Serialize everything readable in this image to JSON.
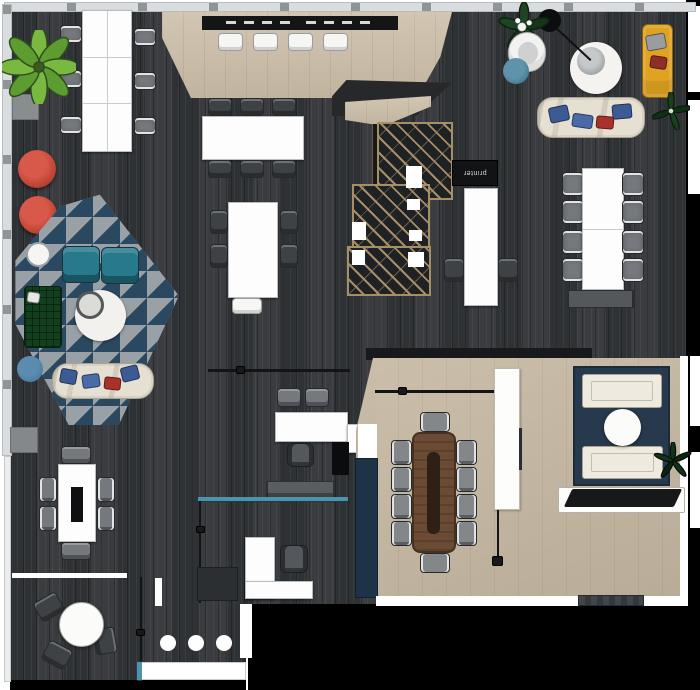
{
  "description": "Top-down 3D rendered office floor plan",
  "labels": {
    "printer": "printer"
  },
  "palette": {
    "floor": "#2f3235",
    "wall": "#dadddf",
    "wall_tick": "#8f9497",
    "beige": "#cdbfa9",
    "beige_room": "#c7b9a3",
    "platform_dark": "#26282a",
    "counter": "#131517",
    "tan": "#a68e67",
    "rug_gray": "#99a1a7",
    "rug_navy": "#2a4860",
    "navy": "#26394d",
    "teal": "#27798b",
    "glass": "#4c93ae",
    "red": "#c24736",
    "green": "#12401f",
    "mustard": "#e0a222",
    "cream": "#e6e0d2",
    "wood": "#6b4b33",
    "runner": "#2d2016",
    "chair": "#75797d",
    "chair_dark": "#3e4245"
  },
  "zones": [
    {
      "id": "top-left-workstations",
      "items": [
        "white 6-seat bench desk",
        "6 task chairs",
        "potted plant",
        "floor mat",
        "2 round red poufs"
      ]
    },
    {
      "id": "top-counter-platform",
      "items": [
        "beige timber platform",
        "black counter with place settings",
        "4 white stools"
      ]
    },
    {
      "id": "center-tables",
      "items": [
        "white 6-seat table",
        "white 4-seat table with end stool"
      ]
    },
    {
      "id": "staircase",
      "items": [
        "open timber-truss staircase"
      ]
    },
    {
      "id": "printer-nook",
      "items": [
        "printer cabinet",
        "white high table",
        "2 dark chairs"
      ]
    },
    {
      "id": "right-workstations",
      "items": [
        "white 8-seat table",
        "storage bench"
      ]
    },
    {
      "id": "top-right-lounge",
      "items": [
        "arc floor lamp",
        "round white rug",
        "white armchair",
        "teal ottoman",
        "flowering plant",
        "mustard seat unit",
        "small plant",
        "cream chaise with cushions"
      ]
    },
    {
      "id": "triangle-rug-lounge",
      "items": [
        "triangle-pattern rug",
        "2 teal armchairs",
        "round side table",
        "green checked sofa",
        "glass coffee table on round rug",
        "blue pouf",
        "cream sofa with cushions"
      ]
    },
    {
      "id": "mid-desks",
      "items": [
        "white desk",
        "3 chairs",
        "black storage box",
        "white return"
      ]
    },
    {
      "id": "lower-office",
      "items": [
        "teal glass partition",
        "gray bench sofa",
        "white L-desk",
        "office chair"
      ]
    },
    {
      "id": "left-meeting",
      "items": [
        "white 6-seat table with planter slot",
        "floor mat"
      ]
    },
    {
      "id": "cafe-corner",
      "items": [
        "round white table",
        "3 dark chairs",
        "3 white floor markers",
        "service counter"
      ]
    },
    {
      "id": "conference-room",
      "items": [
        "beige carpet",
        "walnut boardroom table with runner",
        "10 chairs",
        "whiteboard panel",
        "navy wall bench",
        "glass wall",
        "door mat"
      ]
    },
    {
      "id": "tv-lounge",
      "items": [
        "navy rug",
        "2 white sofas",
        "round coffee table",
        "plant",
        "media console with TV"
      ]
    }
  ]
}
